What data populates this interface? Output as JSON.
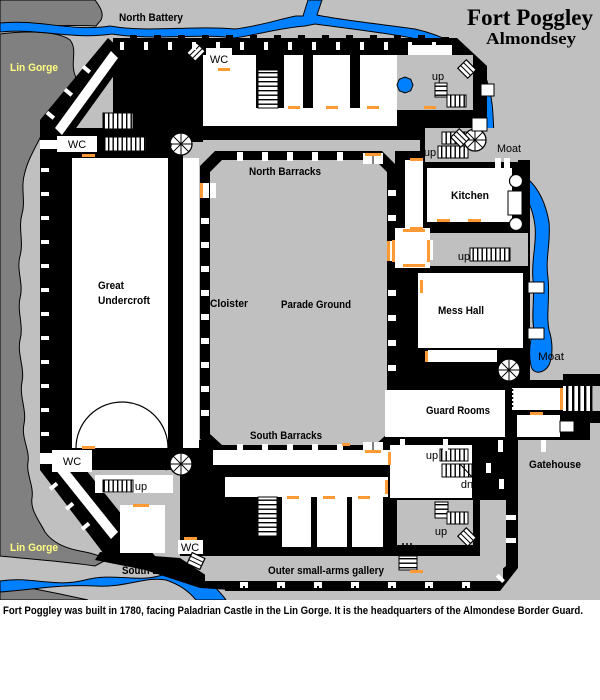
{
  "header": {
    "title": "Fort Poggley",
    "subtitle": "Almondsey"
  },
  "areas": {
    "north_battery": "North Battery",
    "south_battery": "South Battery",
    "lin_gorge": "Lin Gorge",
    "moat": "Moat",
    "north_barracks": "North Barracks",
    "south_barracks": "South Barracks",
    "cloister": "Cloister",
    "parade_ground": "Parade Ground",
    "great_undercroft_line1": "Great",
    "great_undercroft_line2": "Undercroft",
    "kitchen": "Kitchen",
    "mess_hall": "Mess Hall",
    "guard_rooms": "Guard Rooms",
    "gatehouse": "Gatehouse",
    "outer_gallery": "Outer small-arms gallery"
  },
  "markers": {
    "up": "up",
    "down": "dn",
    "wc": "WC"
  },
  "caption": "Fort Poggley was built in 1780, facing Paladrian Castle in the Lin Gorge. It is the headquarters of the Almondese Border Guard.",
  "colors": {
    "land": "#c0c0c0",
    "gorge": "#808080",
    "water": "#0080ff",
    "door": "#ff9933",
    "gorge_label_text": "#ffff80",
    "wall": "#000000",
    "room": "#ffffff"
  }
}
